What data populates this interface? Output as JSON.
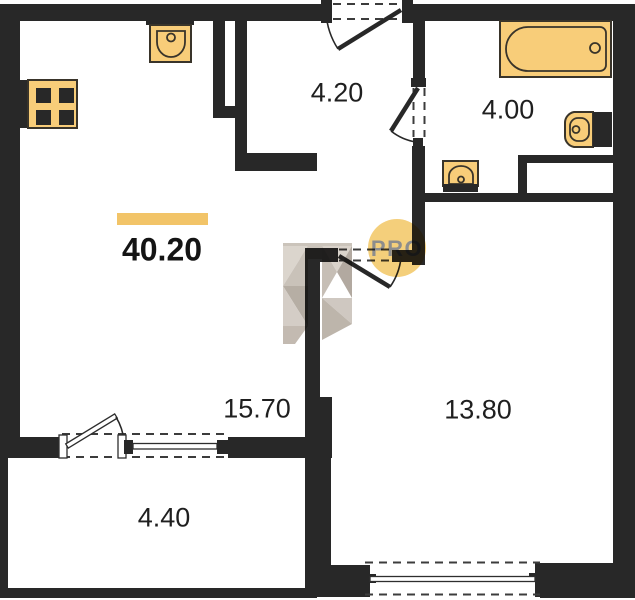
{
  "theme": {
    "wall_color": "#282828",
    "fixture_fill": "#f8cd79",
    "fixture_stroke": "#39342a",
    "accent_bar_color": "#f2c468",
    "watermark_circle_color": "rgba(242,196,94,0.82)",
    "label_color": "#1f1f1f"
  },
  "plan": {
    "total_area": "40.20",
    "rooms": {
      "hallway": "4.20",
      "bathroom": "4.00",
      "living_room": "15.70",
      "bedroom": "13.80",
      "balcony": "4.40"
    },
    "watermark_text": "PRO",
    "fixture_icons": [
      "stove-icon",
      "kitchen-sink-icon",
      "bathtub-icon",
      "toilet-icon",
      "bathroom-sink-icon"
    ]
  }
}
